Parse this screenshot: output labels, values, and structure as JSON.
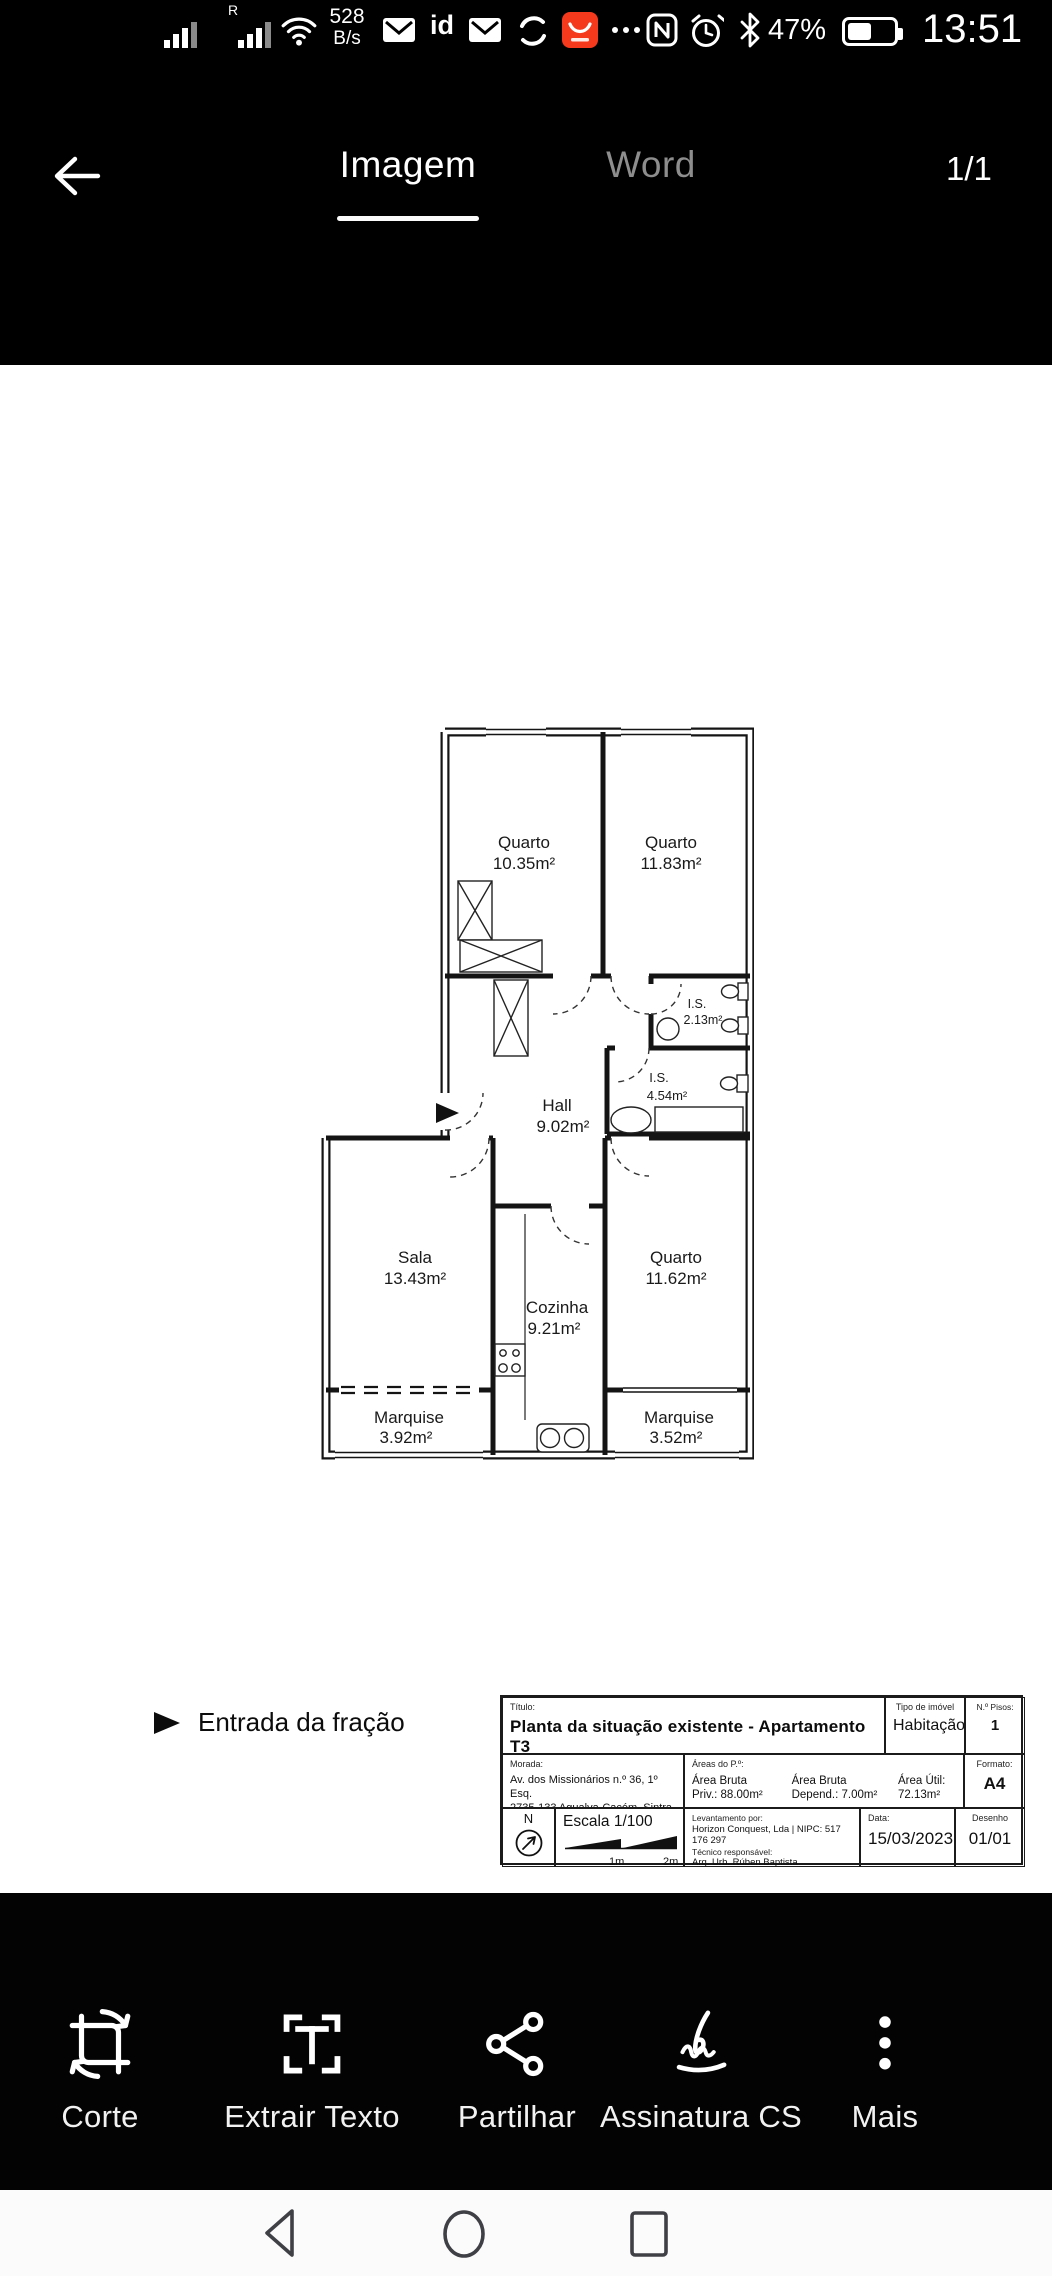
{
  "status_bar": {
    "carrier_indicator": "R",
    "network_speed": "528",
    "network_speed_unit": "B/s",
    "id_badge": "id",
    "battery_percent": "47%",
    "time": "13:51"
  },
  "header": {
    "tab_image": "Imagem",
    "tab_word": "Word",
    "page_indicator": "1/1"
  },
  "plan": {
    "entrance_label": "Entrada da fração",
    "rooms": [
      {
        "name": "Quarto",
        "area": "10.35m²"
      },
      {
        "name": "Quarto",
        "area": "11.83m²"
      },
      {
        "name": "I.S.",
        "area": "2.13m²"
      },
      {
        "name": "I.S.",
        "area": "4.54m²"
      },
      {
        "name": "Hall",
        "area": "9.02m²"
      },
      {
        "name": "Sala",
        "area": "13.43m²"
      },
      {
        "name": "Cozinha",
        "area": "9.21m²"
      },
      {
        "name": "Quarto",
        "area": "11.62m²"
      },
      {
        "name": "Marquise",
        "area": "3.92m²"
      },
      {
        "name": "Marquise",
        "area": "3.52m²"
      }
    ]
  },
  "title_block": {
    "titulo_label": "Título:",
    "titulo": "Planta da situação existente - Apartamento T3",
    "tipo_label": "Tipo de imóvel",
    "tipo": "Habitação",
    "pisos_label": "N.º Pisos:",
    "pisos": "1",
    "morada_label": "Morada:",
    "morada_line1": "Av. dos Missionários n.º 36, 1º Esq.",
    "morada_line2": "2735-133 Agualva-Cacém, Sintra",
    "areas_label": "Áreas do P.º:",
    "area_bruta_priv_l1": "Área Bruta",
    "area_bruta_priv_l2": "Priv.: 88.00m²",
    "area_bruta_dep_l1": "Área Bruta",
    "area_bruta_dep_l2": "Depend.: 7.00m²",
    "area_util_l1": "Área Útil:",
    "area_util_l2": "72.13m²",
    "formato_label": "Formato:",
    "formato": "A4",
    "north": "N",
    "escala": "Escala 1/100",
    "scale_tick_1": "1m",
    "scale_tick_2": "2m",
    "levantamento_label": "Levantamento por:",
    "levantamento": "Horizon Conquest, Lda | NIPC: 517 176 297",
    "tecnico_label": "Técnico responsável:",
    "tecnico": "Arq. Urb. Rúben Baptista",
    "data_label": "Data:",
    "data": "15/03/2023",
    "desenho_label": "Desenho",
    "desenho": "01/01"
  },
  "toolbar": {
    "items": [
      {
        "label": "Corte"
      },
      {
        "label": "Extrair Texto"
      },
      {
        "label": "Partilhar"
      },
      {
        "label": "Assinatura CS"
      },
      {
        "label": "Mais"
      }
    ]
  }
}
